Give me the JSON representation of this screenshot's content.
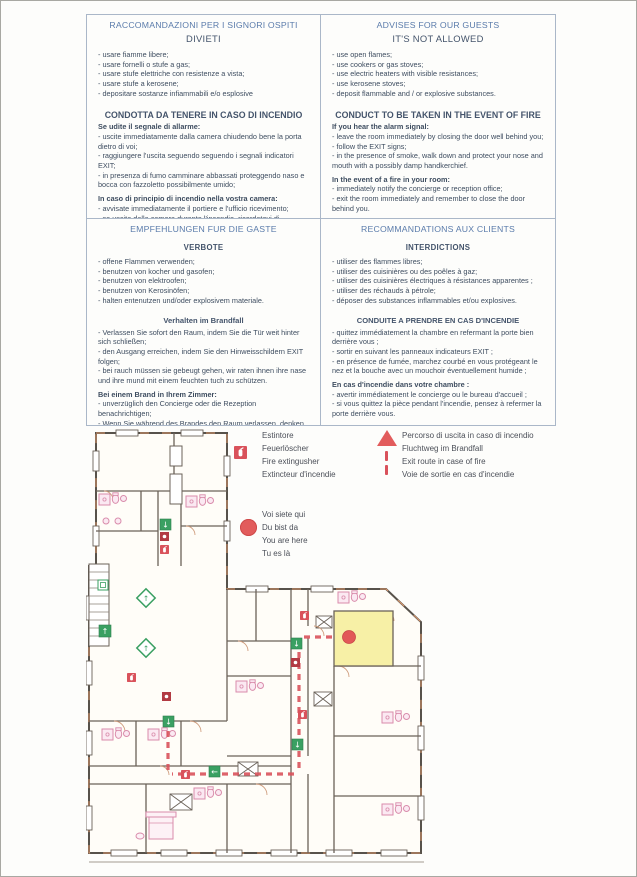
{
  "document": {
    "type": "hotel fire-safety notice with evacuation floor plan",
    "languages": [
      "Italian",
      "English",
      "German",
      "French"
    ]
  },
  "colors": {
    "heading_blue": "#5b7cab",
    "body_text": "#3e4d60",
    "route_red": "#d9525b",
    "exit_green": "#3aa062",
    "highlight_yellow": "#f7f0a6",
    "marker_red": "#e25c5c"
  },
  "panels": [
    {
      "id": "italian",
      "title": "RACCOMANDAZIONI PER I SIGNORI OSPITI",
      "subtitle": "DIVIETI",
      "subtitle_small": false,
      "sections": [
        {
          "heading": "",
          "heading_small": false,
          "lead": "",
          "items": [
            "- usare fiamme libere;",
            "- usare fornelli o stufe a gas;",
            "- usare stufe elettriche con resistenze a vista;",
            "- usare stufe a kerosene;",
            "- depositare sostanze infiammabili e/o esplosive"
          ]
        },
        {
          "heading": "CONDOTTA DA TENERE IN CASO DI INCENDIO",
          "heading_small": false,
          "lead": "Se udite il segnale di allarme:",
          "items": [
            "- uscite immediatamente dalla camera chiudendo bene la porta dietro di voi;",
            "- raggiungere l'uscita seguendo seguendo i segnali indicatori EXIT;",
            "- in presenza di fumo camminare abbassati proteggendo naso e bocca con fazzoletto possibilmente umido;"
          ]
        },
        {
          "heading": "",
          "heading_small": false,
          "lead": "In caso di principio di incendio nella vostra camera:",
          "items": [
            "- avvisate immediatamente il portiere e l'ufficio ricevimento;",
            "- se uscite dalla camera durante l'incendio, ricordatevi di chiudere la porta dietro di voi."
          ]
        }
      ]
    },
    {
      "id": "english",
      "title": "ADVISES FOR OUR GUESTS",
      "subtitle": "IT'S NOT ALLOWED",
      "subtitle_small": false,
      "sections": [
        {
          "heading": "",
          "heading_small": false,
          "lead": "",
          "items": [
            "- use open flames;",
            "- use cookers or gas stoves;",
            "- use electric heaters with visible resistances;",
            "- use kerosene stoves;",
            "- deposit flammable and / or explosive substances."
          ]
        },
        {
          "heading": "CONDUCT TO BE TAKEN IN THE EVENT OF FIRE",
          "heading_small": false,
          "lead": "If you hear the alarm signal:",
          "items": [
            "- leave the room immediately by closing the door well behind you;",
            "- follow the EXIT signs;",
            "- in the presence of smoke, walk down and protect your nose and mouth with a possibly damp handkerchief."
          ]
        },
        {
          "heading": "",
          "heading_small": false,
          "lead": "In the event of a fire in your room:",
          "items": [
            "- immediately notify the concierge or reception office;",
            "- exit the room immediately and remember to close the door behind you."
          ]
        }
      ]
    },
    {
      "id": "german",
      "title": "EMPFEHLUNGEN FUR DIE GASTE",
      "subtitle": "VERBOTE",
      "subtitle_small": true,
      "sections": [
        {
          "heading": "",
          "heading_small": false,
          "lead": "",
          "items": [
            "- offene Flammen verwenden;",
            "- benutzen von kocher und gasofen;",
            "- benutzen von elektroofen;",
            "- benutzen von Kerosinöfen;",
            "- halten entenutzen und/oder explosivem materiale."
          ]
        },
        {
          "heading": "Verhalten im Brandfall",
          "heading_small": true,
          "lead": "",
          "items": [
            "- Verlassen Sie sofort den Raum, indem Sie die Tür weit hinter sich schließen;",
            "- den Ausgang erreichen, indem Sie den Hinweisschildern EXIT folgen;",
            "- bei rauch müssen sie gebeugt gehen, wir raten ihnen ihre nase und ihre mund mit einem feuchten tuch zu schützen."
          ]
        },
        {
          "heading": "",
          "heading_small": false,
          "lead": "Bei einem Brand in Ihrem Zimmer:",
          "items": [
            "- unverzüglich den Concierge oder die Rezeption benachrichtigen;",
            "- Wenn Sie während des Brandes den Raum verlassen, denken Sie daran, die Tür hinter sich zu schließen."
          ]
        }
      ]
    },
    {
      "id": "french",
      "title": "RECOMMANDATIONS AUX CLIENTS",
      "subtitle": "INTERDICTIONS",
      "subtitle_small": true,
      "sections": [
        {
          "heading": "",
          "heading_small": false,
          "lead": "",
          "items": [
            "- utiliser des flammes libres;",
            "- utiliser des cuisinières ou des poêles à gaz;",
            "- utiliser des cuisinières électriques à résistances apparentes ;",
            "- utiliser des réchauds à pétrole;",
            "- déposer des substances inflammables et/ou explosives."
          ]
        },
        {
          "heading": "CONDUITE A PRENDRE EN CAS D'INCENDIE",
          "heading_small": true,
          "lead": "",
          "items": [
            "- quittez immédiatement la chambre en refermant la porte bien derrière vous ;",
            "- sortir en suivant les panneaux indicateurs EXIT ;",
            "- en présence de fumée, marchez courbé en vous protégeant le nez et la bouche avec un mouchoir éventuellement humide ;"
          ]
        },
        {
          "heading": "",
          "heading_small": false,
          "lead": "En cas d'incendie dans votre chambre :",
          "items": [
            "- avertir immédiatement le concierge ou le bureau d'accueil ;",
            "- si vous quittez la pièce pendant l'incendie, pensez à refermer la porte derrière vous."
          ]
        }
      ]
    }
  ],
  "legend": {
    "extinguisher": [
      "Estintore",
      "Feuerlöscher",
      "Fire extingusher",
      "Extincteur d'incendie"
    ],
    "exit_route": [
      "Percorso di uscita in caso di incendio",
      "Fluchtweg im Brandfall",
      "Exit route in case of fire",
      "Voie de sortie en cas d'incendie"
    ],
    "you_are_here": [
      "Voi siete qui",
      "Du bist da",
      "You are here",
      "Tu es là"
    ]
  },
  "floor_plan": {
    "highlighted_room": "yellow room with red you-are-here dot",
    "symbols": {
      "fire_extinguisher_icon": "small red square",
      "exit_sign_icon": "green square with white arrow",
      "escape_route": "red dashed line",
      "you_are_here_marker": "red filled circle"
    }
  }
}
